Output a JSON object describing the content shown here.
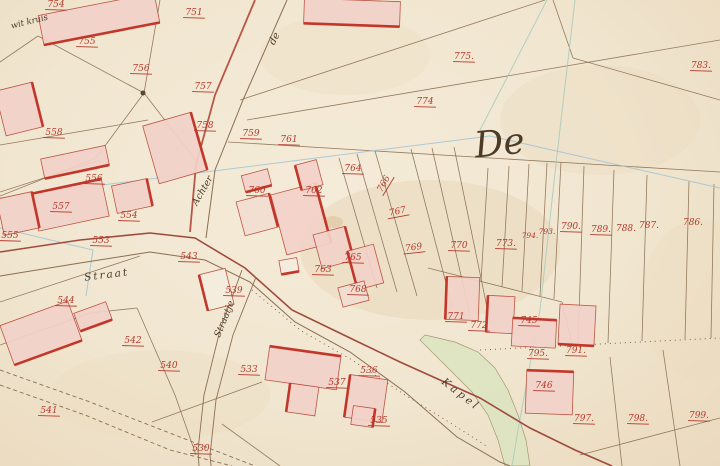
{
  "map": {
    "type": "historical cadastral map",
    "region_script_large": "De",
    "colors": {
      "paper": "#f2e8d4",
      "parcel_line": "#8a6f52",
      "number_red": "#b5392c",
      "building_fill": "#f3d2c9",
      "building_pale": "#f3ddd2",
      "building_white": "#f5eee0",
      "building_stroke": "#b84a3a",
      "building_thick_edge": "#c2372a",
      "road_red_edge": "#b9564a",
      "road_dark_edge": "#9e4b3d",
      "stream_green": "#dce5c1",
      "survey_blue": "#9cc0d6",
      "survey_teal": "#a3c8bd",
      "script_ink": "#4c3b27"
    },
    "place_names": {
      "wit_kruis": "wit kruis",
      "de_small": "de",
      "achter": "Achter",
      "straat": "Straat",
      "straatje": "Straatje",
      "kapel": "Kapel",
      "de_large": "De"
    },
    "parcel_numbers": [
      {
        "n": "754",
        "x": 56,
        "y": 7,
        "u": 1
      },
      {
        "n": "755",
        "x": 87,
        "y": 44,
        "u": 1
      },
      {
        "n": "751",
        "x": 194,
        "y": 15,
        "u": 1
      },
      {
        "n": "756",
        "x": 141,
        "y": 71,
        "u": 1
      },
      {
        "n": "757",
        "x": 203,
        "y": 89,
        "u": 1
      },
      {
        "n": "758",
        "x": 205,
        "y": 128,
        "u": 1
      },
      {
        "n": "558",
        "x": 54,
        "y": 135,
        "u": 1
      },
      {
        "n": "759",
        "x": 251,
        "y": 136,
        "u": 1
      },
      {
        "n": "761",
        "x": 289,
        "y": 142,
        "u": 1
      },
      {
        "n": "760",
        "x": 257,
        "y": 193,
        "u": 1
      },
      {
        "n": "762",
        "x": 314,
        "y": 193,
        "u": 1
      },
      {
        "n": "764",
        "x": 353,
        "y": 171,
        "u": 1
      },
      {
        "n": "766",
        "x": 386,
        "y": 185,
        "r": -60,
        "u": 1
      },
      {
        "n": "767",
        "x": 398,
        "y": 214,
        "r": -12,
        "u": 1
      },
      {
        "n": "769",
        "x": 414,
        "y": 250,
        "r": -8,
        "u": 1
      },
      {
        "n": "770",
        "x": 459,
        "y": 248,
        "u": 1
      },
      {
        "n": "763",
        "x": 323,
        "y": 272,
        "u": 1
      },
      {
        "n": "765",
        "x": 353,
        "y": 260,
        "u": 1
      },
      {
        "n": "768",
        "x": 358,
        "y": 292,
        "u": 1
      },
      {
        "n": "774",
        "x": 425,
        "y": 104,
        "u": 1
      },
      {
        "n": "775.",
        "x": 464,
        "y": 59,
        "u": 1
      },
      {
        "n": "783.",
        "x": 701,
        "y": 68,
        "u": 1
      },
      {
        "n": "773.",
        "x": 506,
        "y": 246,
        "u": 1
      },
      {
        "n": "794.",
        "x": 530,
        "y": 238,
        "s": 7.5
      },
      {
        "n": "793.",
        "x": 547,
        "y": 234,
        "s": 7.5
      },
      {
        "n": "790.",
        "x": 571,
        "y": 229,
        "u": 1
      },
      {
        "n": "789.",
        "x": 601,
        "y": 232,
        "u": 1
      },
      {
        "n": "788.",
        "x": 626,
        "y": 231
      },
      {
        "n": "787.",
        "x": 649,
        "y": 228
      },
      {
        "n": "786.",
        "x": 693,
        "y": 225
      },
      {
        "n": "556",
        "x": 94,
        "y": 181,
        "u": 1
      },
      {
        "n": "557",
        "x": 61,
        "y": 209,
        "u": 1
      },
      {
        "n": "555",
        "x": 10,
        "y": 238,
        "u": 1
      },
      {
        "n": "554",
        "x": 129,
        "y": 218,
        "u": 1
      },
      {
        "n": "553",
        "x": 101,
        "y": 243,
        "u": 1
      },
      {
        "n": "543",
        "x": 189,
        "y": 259,
        "u": 1
      },
      {
        "n": "544",
        "x": 66,
        "y": 303,
        "u": 1
      },
      {
        "n": "539",
        "x": 234,
        "y": 293,
        "u": 1
      },
      {
        "n": "542",
        "x": 133,
        "y": 343,
        "u": 1
      },
      {
        "n": "540",
        "x": 169,
        "y": 368,
        "u": 1
      },
      {
        "n": "541",
        "x": 49,
        "y": 413,
        "u": 1
      },
      {
        "n": "530",
        "x": 201,
        "y": 451,
        "u": 1
      },
      {
        "n": "533",
        "x": 249,
        "y": 372,
        "u": 1
      },
      {
        "n": "537",
        "x": 337,
        "y": 385,
        "u": 1
      },
      {
        "n": "536",
        "x": 369,
        "y": 373,
        "u": 1
      },
      {
        "n": "535",
        "x": 379,
        "y": 423,
        "u": 1
      },
      {
        "n": "771",
        "x": 456,
        "y": 319,
        "u": 1
      },
      {
        "n": "772",
        "x": 479,
        "y": 328,
        "u": 1
      },
      {
        "n": "745",
        "x": 529,
        "y": 323,
        "u": 1
      },
      {
        "n": "795.",
        "x": 538,
        "y": 356,
        "u": 1
      },
      {
        "n": "791.",
        "x": 576,
        "y": 353,
        "u": 1
      },
      {
        "n": "746",
        "x": 544,
        "y": 388,
        "u": 1
      },
      {
        "n": "797.",
        "x": 584,
        "y": 421,
        "u": 1
      },
      {
        "n": "798.",
        "x": 638,
        "y": 421,
        "u": 1
      },
      {
        "n": "799.",
        "x": 699,
        "y": 418,
        "u": 1
      }
    ],
    "buildings": [
      [
        40,
        4,
        118,
        30,
        -11,
        "s",
        ""
      ],
      [
        0,
        86,
        38,
        46,
        -14,
        "e",
        ""
      ],
      [
        42,
        152,
        66,
        20,
        -12,
        "s",
        ""
      ],
      [
        34,
        186,
        72,
        38,
        -12,
        "n",
        ""
      ],
      [
        114,
        182,
        36,
        28,
        -12,
        "e",
        ""
      ],
      [
        150,
        118,
        50,
        60,
        -16,
        "e",
        ""
      ],
      [
        278,
        188,
        46,
        62,
        -15,
        "e",
        ""
      ],
      [
        298,
        162,
        22,
        26,
        -15,
        "w",
        ""
      ],
      [
        243,
        172,
        27,
        17,
        -15,
        "s",
        ""
      ],
      [
        240,
        197,
        34,
        35,
        -15,
        "e",
        "pale"
      ],
      [
        317,
        230,
        33,
        35,
        -15,
        "e",
        ""
      ],
      [
        352,
        247,
        27,
        40,
        -15,
        "w",
        ""
      ],
      [
        340,
        284,
        27,
        20,
        -15,
        "",
        "pale"
      ],
      [
        280,
        259,
        18,
        14,
        -10,
        "s",
        "white"
      ],
      [
        446,
        277,
        33,
        43,
        2,
        "w",
        ""
      ],
      [
        487,
        296,
        27,
        37,
        3,
        "w",
        ""
      ],
      [
        512,
        319,
        44,
        28,
        3,
        "n",
        ""
      ],
      [
        559,
        305,
        36,
        40,
        3,
        "s",
        ""
      ],
      [
        526,
        371,
        47,
        43,
        2,
        "n",
        ""
      ],
      [
        267,
        351,
        72,
        34,
        8,
        "n",
        ""
      ],
      [
        288,
        385,
        29,
        29,
        8,
        "w",
        ""
      ],
      [
        347,
        377,
        38,
        43,
        8,
        "w",
        ""
      ],
      [
        352,
        407,
        22,
        19,
        8,
        "e",
        ""
      ],
      [
        5,
        312,
        72,
        42,
        -20,
        "s",
        ""
      ],
      [
        76,
        307,
        34,
        19,
        -20,
        "s",
        ""
      ],
      [
        203,
        271,
        27,
        37,
        -14,
        "w",
        "white"
      ],
      [
        304,
        0,
        96,
        25,
        2,
        "s",
        ""
      ],
      [
        0,
        195,
        36,
        37,
        -12,
        "e",
        ""
      ]
    ],
    "parcel_lines": [
      [
        160,
        0,
        144,
        93
      ],
      [
        38,
        36,
        144,
        93
      ],
      [
        0,
        62,
        38,
        36
      ],
      [
        144,
        93,
        197,
        162
      ],
      [
        144,
        93,
        96,
        158
      ],
      [
        96,
        158,
        0,
        196
      ],
      [
        240,
        100,
        545,
        0
      ],
      [
        247,
        120,
        720,
        40
      ],
      [
        228,
        142,
        720,
        172
      ],
      [
        553,
        0,
        573,
        58
      ],
      [
        573,
        58,
        720,
        100
      ],
      [
        488,
        168,
        481,
        281
      ],
      [
        509,
        166,
        502,
        287
      ],
      [
        529,
        164,
        522,
        291
      ],
      [
        547,
        163,
        540,
        296
      ],
      [
        561,
        162,
        554,
        299
      ],
      [
        584,
        166,
        578,
        344
      ],
      [
        614,
        170,
        608,
        343
      ],
      [
        647,
        175,
        642,
        341
      ],
      [
        689,
        181,
        685,
        339
      ],
      [
        714,
        184,
        711,
        338
      ],
      [
        339,
        158,
        377,
        288
      ],
      [
        357,
        154,
        397,
        292
      ],
      [
        375,
        151,
        417,
        296
      ],
      [
        411,
        149,
        452,
        306
      ],
      [
        432,
        148,
        470,
        315
      ],
      [
        454,
        147,
        490,
        322
      ],
      [
        428,
        268,
        562,
        302
      ],
      [
        562,
        302,
        572,
        344
      ],
      [
        0,
        145,
        148,
        120
      ],
      [
        0,
        192,
        100,
        160
      ],
      [
        0,
        302,
        140,
        256
      ],
      [
        137,
        308,
        175,
        395
      ],
      [
        175,
        395,
        196,
        455
      ],
      [
        152,
        422,
        262,
        382
      ],
      [
        222,
        424,
        280,
        466
      ],
      [
        663,
        350,
        680,
        466
      ],
      [
        610,
        357,
        622,
        466
      ],
      [
        580,
        455,
        720,
        418
      ],
      [
        0,
        345,
        90,
        313
      ],
      [
        90,
        313,
        137,
        308
      ]
    ],
    "survey_lines": [
      {
        "c": "#9cc0d6",
        "pts": [
          [
            0,
            198
          ],
          [
            490,
            136
          ],
          [
            720,
            188
          ]
        ]
      },
      {
        "c": "#a3c8bd",
        "pts": [
          [
            575,
            0
          ],
          [
            557,
            155
          ],
          [
            540,
            310
          ],
          [
            518,
            430
          ],
          [
            512,
            466
          ]
        ]
      },
      {
        "c": "#a3c8bd",
        "pts": [
          [
            547,
            0
          ],
          [
            480,
            130
          ]
        ]
      },
      {
        "c": "#9cc0d6",
        "pts": [
          [
            0,
            228
          ],
          [
            93,
            250
          ],
          [
            86,
            296
          ]
        ]
      }
    ],
    "roads": [
      {
        "c": "#b9564a",
        "w": 1.8,
        "pts": [
          [
            255,
            0
          ],
          [
            215,
            95
          ],
          [
            196,
            165
          ],
          [
            190,
            232
          ]
        ]
      },
      {
        "c": "#8a6f52",
        "w": 1,
        "pts": [
          [
            287,
            0
          ],
          [
            243,
            100
          ],
          [
            215,
            170
          ],
          [
            206,
            238
          ]
        ]
      },
      {
        "c": "#9e4b3d",
        "w": 1.6,
        "pts": [
          [
            0,
            252
          ],
          [
            80,
            240
          ],
          [
            150,
            233
          ],
          [
            195,
            238
          ],
          [
            245,
            268
          ],
          [
            292,
            310
          ],
          [
            350,
            338
          ],
          [
            400,
            362
          ],
          [
            440,
            380
          ],
          [
            480,
            398
          ],
          [
            530,
            428
          ],
          [
            575,
            450
          ],
          [
            612,
            466
          ]
        ]
      },
      {
        "c": "#8a6f52",
        "w": 1,
        "pts": [
          [
            0,
            276
          ],
          [
            80,
            263
          ],
          [
            150,
            252
          ],
          [
            205,
            260
          ],
          [
            250,
            282
          ],
          [
            295,
            322
          ],
          [
            350,
            352
          ],
          [
            405,
            392
          ],
          [
            457,
            437
          ],
          [
            500,
            462
          ],
          [
            510,
            466
          ]
        ]
      },
      {
        "c": "#8a6f52",
        "w": 0.9,
        "pts": [
          [
            242,
            270
          ],
          [
            220,
            330
          ],
          [
            204,
            395
          ],
          [
            198,
            450
          ],
          [
            199,
            466
          ]
        ]
      },
      {
        "c": "#8a6f52",
        "w": 0.9,
        "pts": [
          [
            256,
            277
          ],
          [
            233,
            335
          ],
          [
            216,
            400
          ],
          [
            210,
            455
          ],
          [
            211,
            466
          ]
        ]
      },
      {
        "c": "#8a6f52",
        "w": 0.9,
        "dash": "4 3",
        "pts": [
          [
            0,
            370
          ],
          [
            90,
            402
          ],
          [
            180,
            437
          ],
          [
            255,
            466
          ]
        ]
      },
      {
        "c": "#8a6f52",
        "w": 0.9,
        "dash": "4 3",
        "pts": [
          [
            0,
            385
          ],
          [
            85,
            415
          ],
          [
            170,
            450
          ],
          [
            232,
            466
          ]
        ]
      },
      {
        "c": "#7c6246",
        "w": 1,
        "dash": "1 4",
        "pts": [
          [
            252,
            290
          ],
          [
            300,
            330
          ],
          [
            352,
            360
          ],
          [
            405,
            395
          ],
          [
            452,
            424
          ],
          [
            488,
            447
          ]
        ]
      },
      {
        "c": "#7c6246",
        "w": 1,
        "dash": "1 4",
        "pts": [
          [
            480,
            350
          ],
          [
            560,
            346
          ],
          [
            640,
            342
          ],
          [
            720,
            338
          ]
        ]
      }
    ],
    "stream": {
      "fill": "#dce5c1",
      "points": [
        [
          425,
          335
        ],
        [
          455,
          342
        ],
        [
          478,
          352
        ],
        [
          495,
          368
        ],
        [
          508,
          390
        ],
        [
          518,
          415
        ],
        [
          526,
          440
        ],
        [
          530,
          466
        ],
        [
          505,
          466
        ],
        [
          498,
          440
        ],
        [
          488,
          415
        ],
        [
          472,
          392
        ],
        [
          452,
          372
        ],
        [
          432,
          352
        ],
        [
          420,
          340
        ]
      ]
    },
    "stains": [
      [
        430,
        250,
        130,
        70,
        "#e7d5b5",
        0.45
      ],
      [
        600,
        120,
        100,
        55,
        "#ead9bc",
        0.35
      ],
      [
        160,
        395,
        110,
        45,
        "#ead9bc",
        0.3
      ],
      [
        345,
        55,
        85,
        40,
        "#ead9bc",
        0.3
      ],
      [
        700,
        300,
        60,
        80,
        "#ead9bc",
        0.3
      ],
      [
        333,
        222,
        10,
        6,
        "#d9b98e",
        0.45
      ]
    ],
    "marker": {
      "x": 143,
      "y": 93,
      "r": 2.5,
      "c": "#5a4632"
    }
  }
}
